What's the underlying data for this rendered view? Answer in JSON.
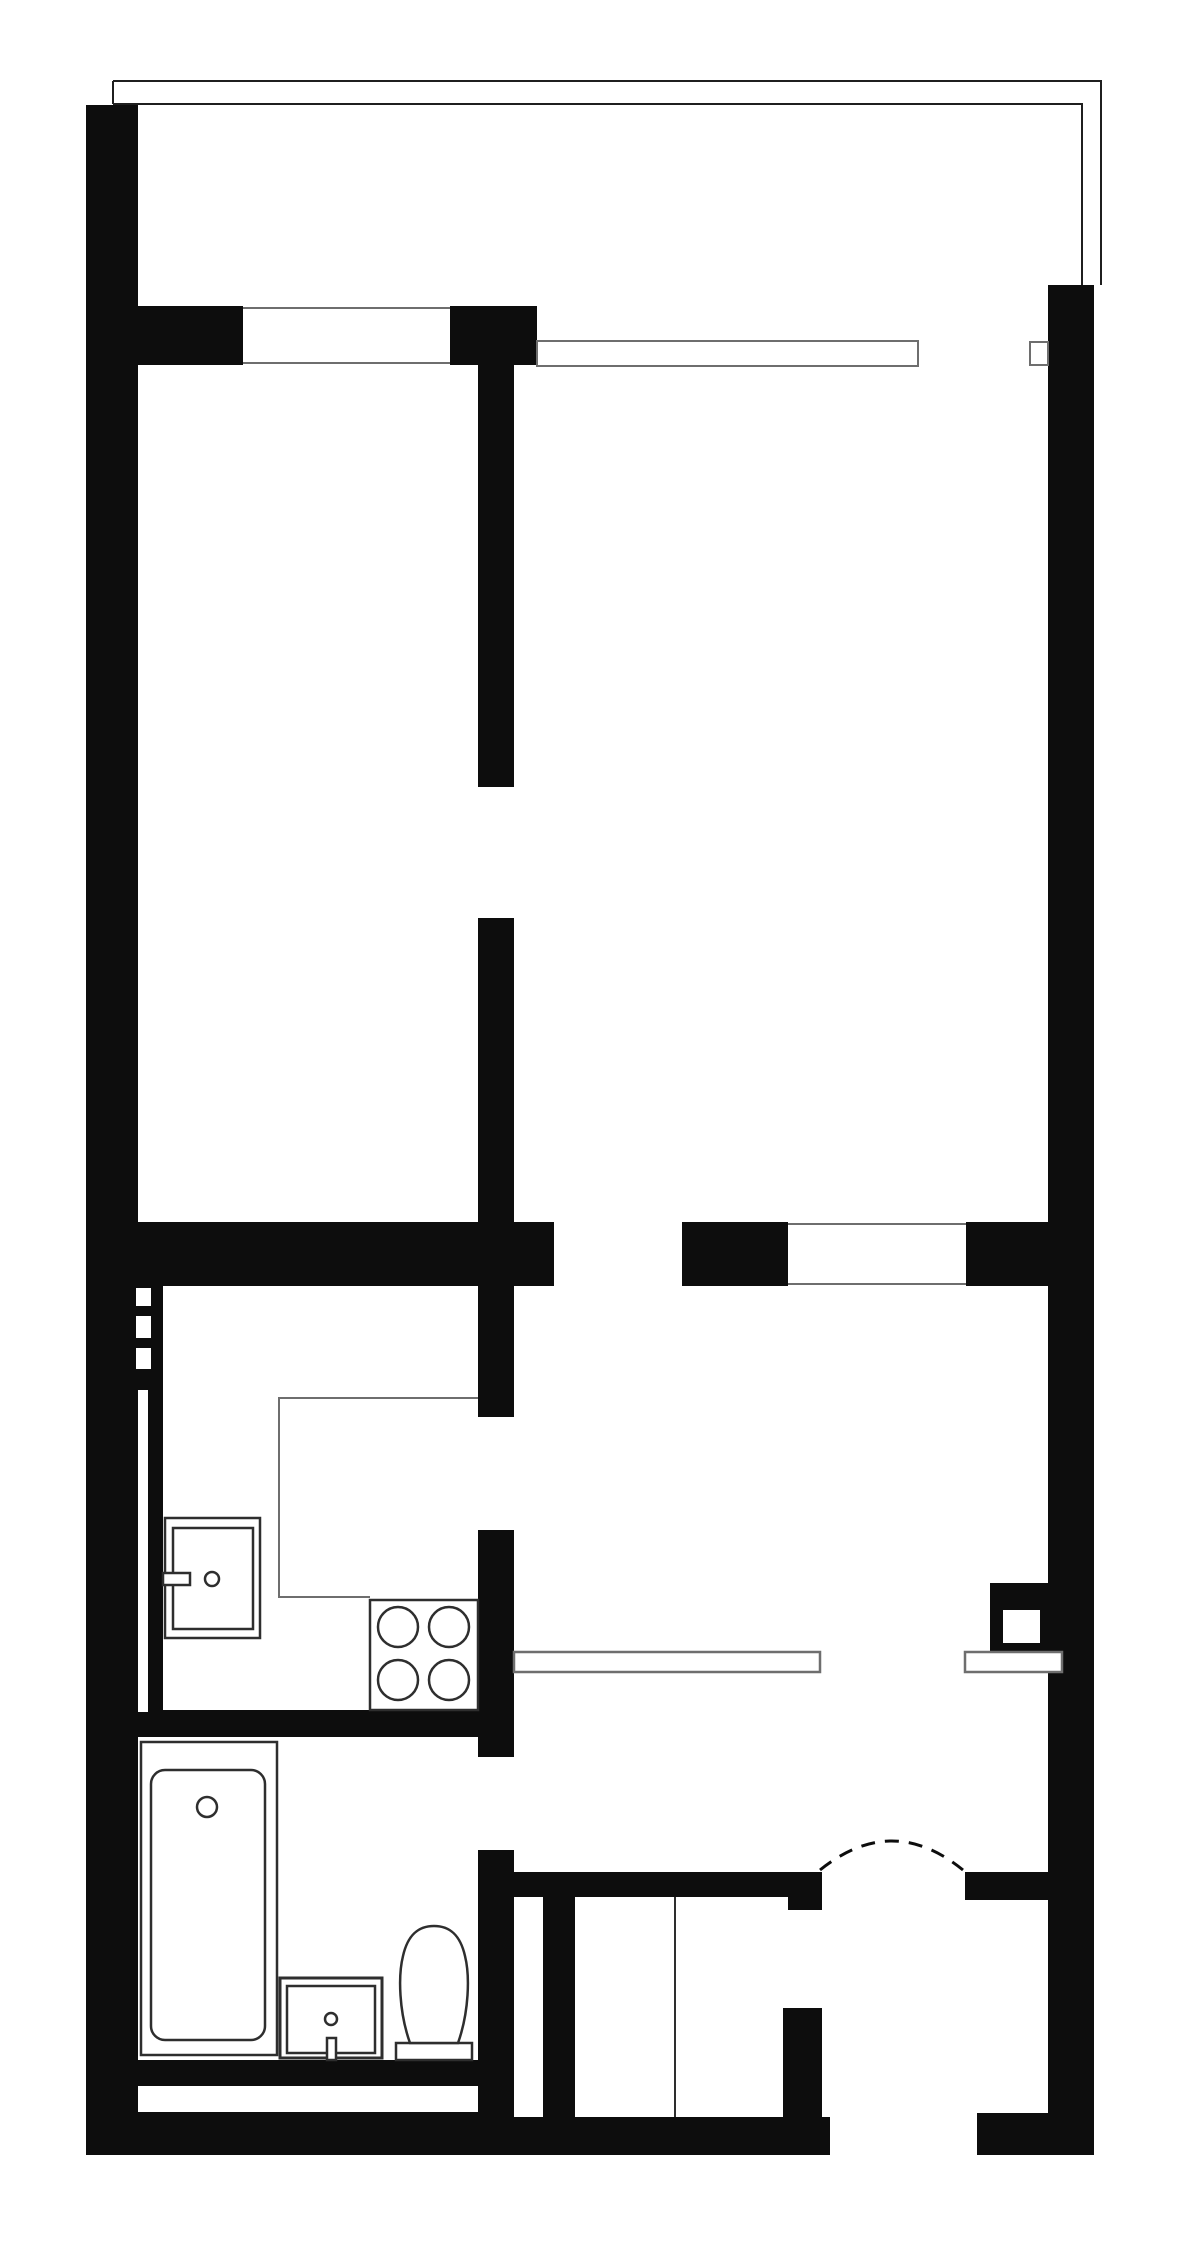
{
  "diagram": {
    "type": "apartment-floor-plan",
    "description": "black-and-white architectural floor plan of a one-bedroom apartment with balcony, living room, bedroom, kitchen, bathroom, hall and entry",
    "canvas": {
      "width": 1200,
      "height": 2255,
      "background": "#ffffff"
    },
    "colors": {
      "wall": "#0d0d0d",
      "thin_gray": "#6e6e6e",
      "fixture": "#2e2e2e",
      "balcony_line": "#1f1f1f",
      "white": "#ffffff"
    },
    "walls": [
      {
        "name": "left-exterior-wall",
        "x": 86,
        "y": 105,
        "w": 52,
        "h": 2050
      },
      {
        "name": "top-wall-left-segment",
        "x": 138,
        "y": 306,
        "w": 105,
        "h": 59
      },
      {
        "name": "top-wall-center-block",
        "x": 450,
        "y": 306,
        "w": 87,
        "h": 59
      },
      {
        "name": "right-exterior-wall",
        "x": 1048,
        "y": 285,
        "w": 46,
        "h": 1870
      },
      {
        "name": "partition-wall-upper",
        "x": 478,
        "y": 365,
        "w": 36,
        "h": 422
      },
      {
        "name": "partition-wall-middle",
        "x": 478,
        "y": 918,
        "w": 36,
        "h": 499
      },
      {
        "name": "partition-wall-lower",
        "x": 478,
        "y": 1530,
        "w": 36,
        "h": 227
      },
      {
        "name": "partition-wall-bottom",
        "x": 478,
        "y": 1850,
        "w": 36,
        "h": 267
      },
      {
        "name": "mid-wall-left-segment",
        "x": 138,
        "y": 1222,
        "w": 416,
        "h": 64
      },
      {
        "name": "mid-wall-right-segment-a",
        "x": 682,
        "y": 1222,
        "w": 106,
        "h": 64
      },
      {
        "name": "mid-wall-right-segment-b",
        "x": 966,
        "y": 1222,
        "w": 82,
        "h": 64
      },
      {
        "name": "kitchen-furring-strip",
        "x": 138,
        "y": 1286,
        "w": 25,
        "h": 426
      },
      {
        "name": "kitchen-bath-wall",
        "x": 138,
        "y": 1710,
        "w": 376,
        "h": 27
      },
      {
        "name": "hall-top-wall-band",
        "x": 478,
        "y": 1872,
        "w": 344,
        "h": 25
      },
      {
        "name": "hall-wall-step",
        "x": 788,
        "y": 1897,
        "w": 34,
        "h": 13
      },
      {
        "name": "hall-top-wall-right",
        "x": 965,
        "y": 1872,
        "w": 83,
        "h": 28
      },
      {
        "name": "closet-left-bar",
        "x": 543,
        "y": 1897,
        "w": 32,
        "h": 220
      },
      {
        "name": "closet-right-bar",
        "x": 783,
        "y": 2008,
        "w": 39,
        "h": 109
      },
      {
        "name": "bath-bottom-wall",
        "x": 138,
        "y": 2060,
        "w": 376,
        "h": 95
      },
      {
        "name": "hall-bottom-wall",
        "x": 514,
        "y": 2117,
        "w": 316,
        "h": 38
      },
      {
        "name": "entry-bottom-wall",
        "x": 977,
        "y": 2113,
        "w": 117,
        "h": 42
      },
      {
        "name": "duct-block",
        "x": 990,
        "y": 1583,
        "w": 58,
        "h": 87
      }
    ],
    "white_overlays": [
      {
        "name": "vent-dash-1",
        "x": 136,
        "y": 1288,
        "w": 15,
        "h": 18
      },
      {
        "name": "vent-dash-2",
        "x": 136,
        "y": 1316,
        "w": 15,
        "h": 22
      },
      {
        "name": "vent-dash-3",
        "x": 136,
        "y": 1348,
        "w": 15,
        "h": 21
      },
      {
        "name": "wall-channel",
        "x": 138,
        "y": 1390,
        "w": 10,
        "h": 322
      },
      {
        "name": "bath-wall-inset",
        "x": 138,
        "y": 2086,
        "w": 340,
        "h": 26
      },
      {
        "name": "duct-window",
        "x": 1003,
        "y": 1610,
        "w": 37,
        "h": 33
      }
    ],
    "outlined_rects": [
      {
        "name": "window-band-right",
        "x": 537,
        "y": 341,
        "w": 381,
        "h": 25,
        "sw": 2,
        "stroke": "thin_gray"
      },
      {
        "name": "window-notch",
        "x": 1030,
        "y": 342,
        "w": 18,
        "h": 23,
        "sw": 2,
        "stroke": "thin_gray"
      },
      {
        "name": "hall-shelf",
        "x": 514,
        "y": 1652,
        "w": 306,
        "h": 20,
        "sw": 2.5,
        "stroke": "thin_gray"
      },
      {
        "name": "entry-shelf",
        "x": 965,
        "y": 1652,
        "w": 97,
        "h": 20,
        "sw": 2.5,
        "stroke": "thin_gray"
      },
      {
        "name": "stove",
        "x": 370,
        "y": 1600,
        "w": 108,
        "h": 110,
        "sw": 2.5,
        "stroke": "fixture"
      },
      {
        "name": "kitchen-sink-outer",
        "x": 165,
        "y": 1518,
        "w": 95,
        "h": 120,
        "sw": 2.5,
        "stroke": "fixture"
      },
      {
        "name": "kitchen-sink-inner",
        "x": 173,
        "y": 1528,
        "w": 80,
        "h": 101,
        "sw": 2.5,
        "stroke": "fixture"
      },
      {
        "name": "sink-handle",
        "x": 163,
        "y": 1573,
        "w": 27,
        "h": 12,
        "sw": 2.5,
        "stroke": "fixture"
      },
      {
        "name": "bathtub-outer",
        "x": 141,
        "y": 1742,
        "w": 136,
        "h": 313,
        "sw": 2.5,
        "stroke": "fixture"
      },
      {
        "name": "bathtub-inner",
        "x": 151,
        "y": 1770,
        "w": 114,
        "h": 270,
        "sw": 2.5,
        "stroke": "fixture",
        "rx": 14
      },
      {
        "name": "washbasin-outer",
        "x": 280,
        "y": 1978,
        "w": 102,
        "h": 80,
        "sw": 3,
        "stroke": "fixture"
      },
      {
        "name": "washbasin-inner",
        "x": 287,
        "y": 1986,
        "w": 88,
        "h": 67,
        "sw": 2.5,
        "stroke": "fixture"
      },
      {
        "name": "washbasin-tap",
        "x": 327,
        "y": 2038,
        "w": 9,
        "h": 22,
        "sw": 2.5,
        "stroke": "fixture"
      },
      {
        "name": "toilet-tank",
        "x": 396,
        "y": 2043,
        "w": 76,
        "h": 17,
        "sw": 2.5,
        "stroke": "fixture"
      }
    ],
    "circles": [
      {
        "name": "stove-burner-1",
        "cx": 398,
        "cy": 1627,
        "r": 20,
        "sw": 2.5
      },
      {
        "name": "stove-burner-2",
        "cx": 449,
        "cy": 1627,
        "r": 20,
        "sw": 2.5
      },
      {
        "name": "stove-burner-3",
        "cx": 398,
        "cy": 1680,
        "r": 20,
        "sw": 2.5
      },
      {
        "name": "stove-burner-4",
        "cx": 449,
        "cy": 1680,
        "r": 20,
        "sw": 2.5
      },
      {
        "name": "sink-faucet",
        "cx": 212,
        "cy": 1579,
        "r": 7,
        "sw": 2.5
      },
      {
        "name": "bathtub-drain",
        "cx": 207,
        "cy": 1807,
        "r": 10,
        "sw": 2.5
      },
      {
        "name": "washbasin-drain",
        "cx": 331,
        "cy": 2019,
        "r": 6,
        "sw": 2.5
      }
    ],
    "lines": [
      {
        "name": "balcony-outer-line",
        "points": "113,81 1101,81 1101,285",
        "sw": 2,
        "stroke": "balcony_line"
      },
      {
        "name": "balcony-corner-tick",
        "points": "113,81 113,104",
        "sw": 2,
        "stroke": "balcony_line"
      },
      {
        "name": "balcony-inner-line",
        "points": "113,104 1082,104 1082,285",
        "sw": 2,
        "stroke": "balcony_line"
      },
      {
        "name": "window-left-top-line",
        "points": "243,308 450,308",
        "sw": 2,
        "stroke": "thin_gray"
      },
      {
        "name": "window-left-bottom-line",
        "points": "243,363 450,363",
        "sw": 2,
        "stroke": "thin_gray"
      },
      {
        "name": "window-mid-top-line",
        "points": "788,1224 966,1224",
        "sw": 2,
        "stroke": "thin_gray"
      },
      {
        "name": "window-mid-bottom-line",
        "points": "788,1284 966,1284",
        "sw": 2,
        "stroke": "thin_gray"
      },
      {
        "name": "kitchen-counter-edge",
        "points": "478,1398 279,1398 279,1597 370,1597",
        "sw": 2,
        "stroke": "thin_gray"
      },
      {
        "name": "closet-divider",
        "points": "675,1897 675,2117",
        "sw": 2,
        "stroke": "fixture"
      }
    ],
    "paths": [
      {
        "name": "toilet-bowl",
        "d": "M 410 2043 C 399 2012 398 1976 403 1956 C 408 1934 419 1926 434 1926 C 449 1926 460 1934 465 1956 C 470 1976 469 2012 458 2043 Z",
        "sw": 2.5,
        "stroke": "fixture",
        "fill": "white",
        "dashed": false
      },
      {
        "name": "entry-door-swing-arc",
        "d": "M 820 1870 Q 892 1812 963 1870",
        "sw": 3,
        "stroke": "wall",
        "fill": "none",
        "dashed": true
      }
    ]
  }
}
